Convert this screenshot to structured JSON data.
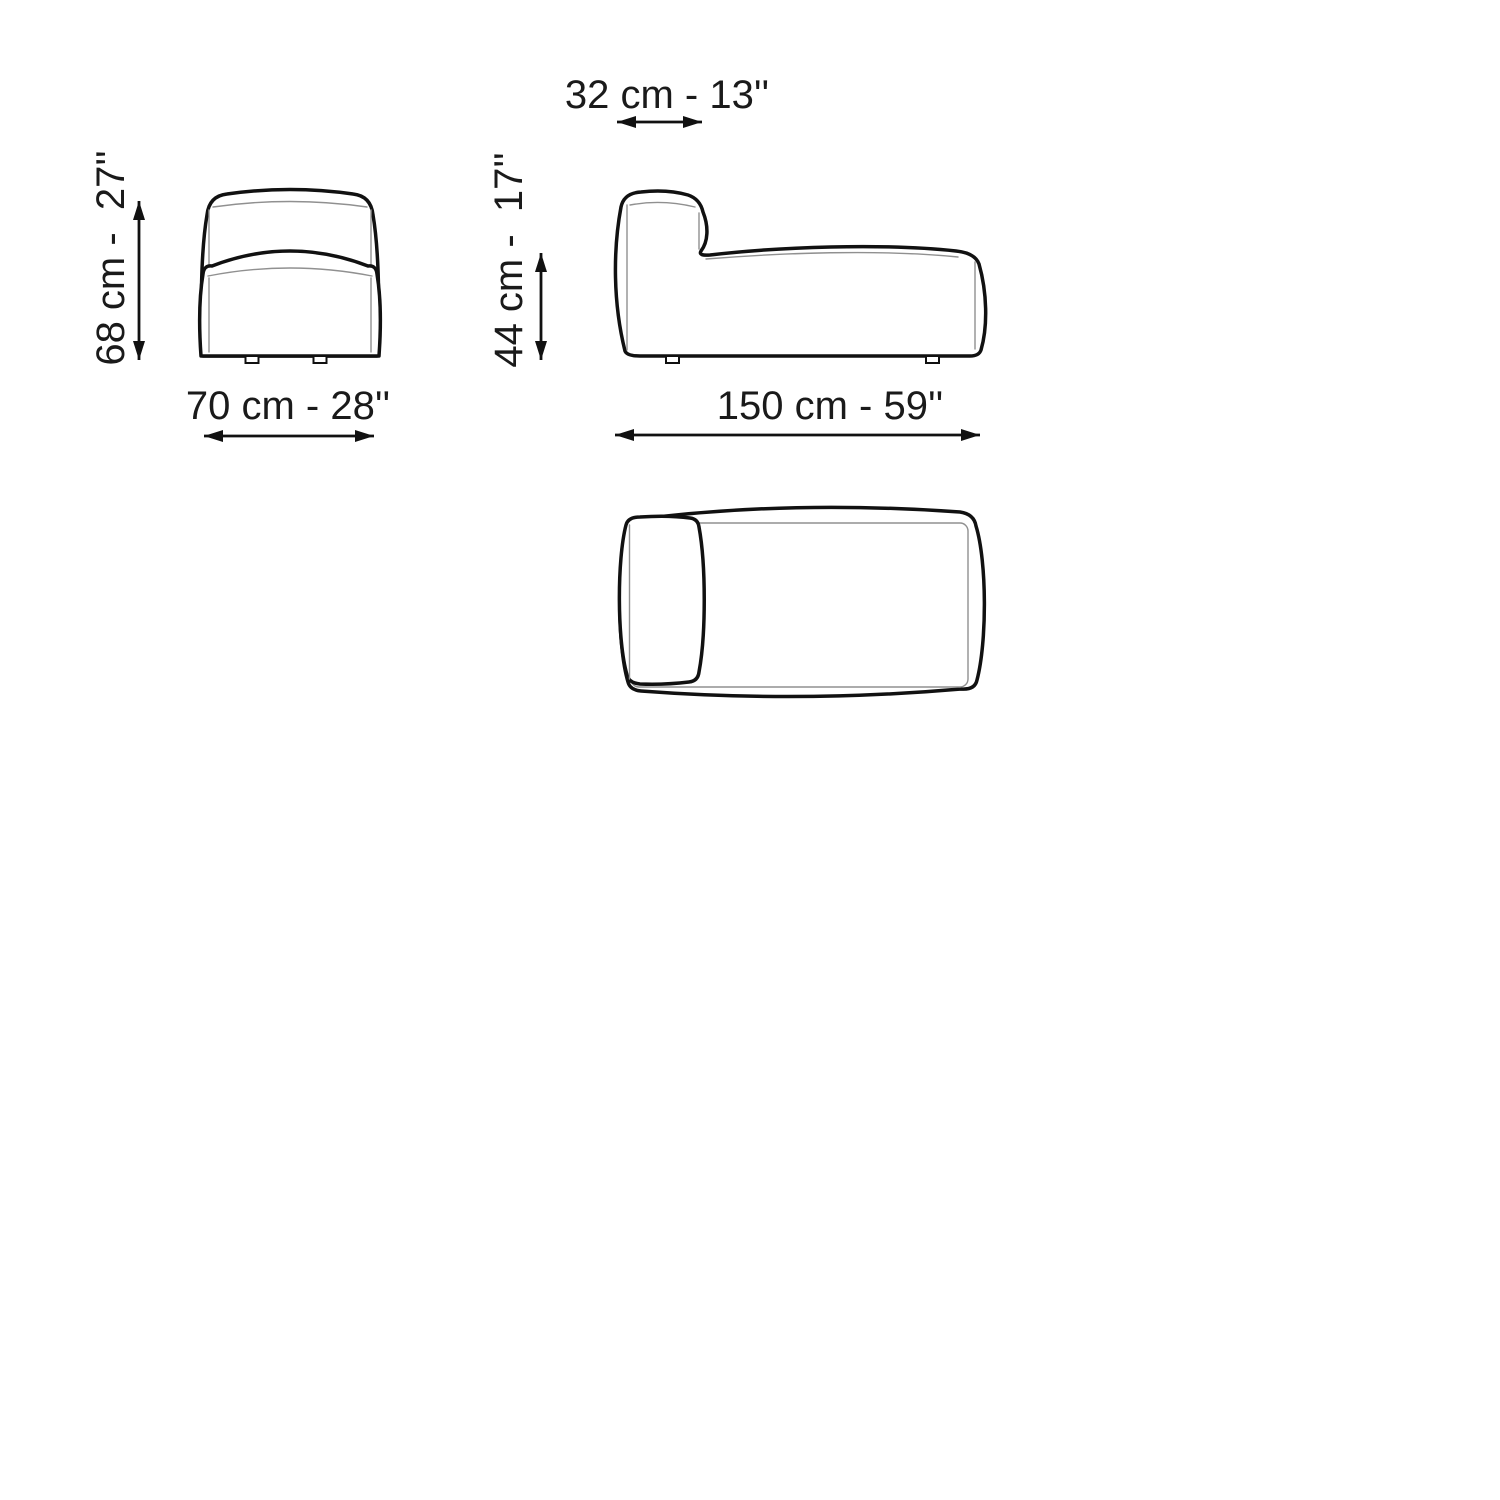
{
  "diagram": {
    "views": {
      "front": {
        "height_label": "68 cm -  27''",
        "width_label": "70 cm - 28''"
      },
      "side": {
        "backrest_depth_label": "32 cm - 13''",
        "seat_height_label": "44 cm -  17''",
        "length_label": "150 cm - 59''"
      }
    },
    "colors": {
      "line": "#111111",
      "thin_line": "#909090",
      "text": "#1a1a1a",
      "background": "#ffffff"
    }
  }
}
